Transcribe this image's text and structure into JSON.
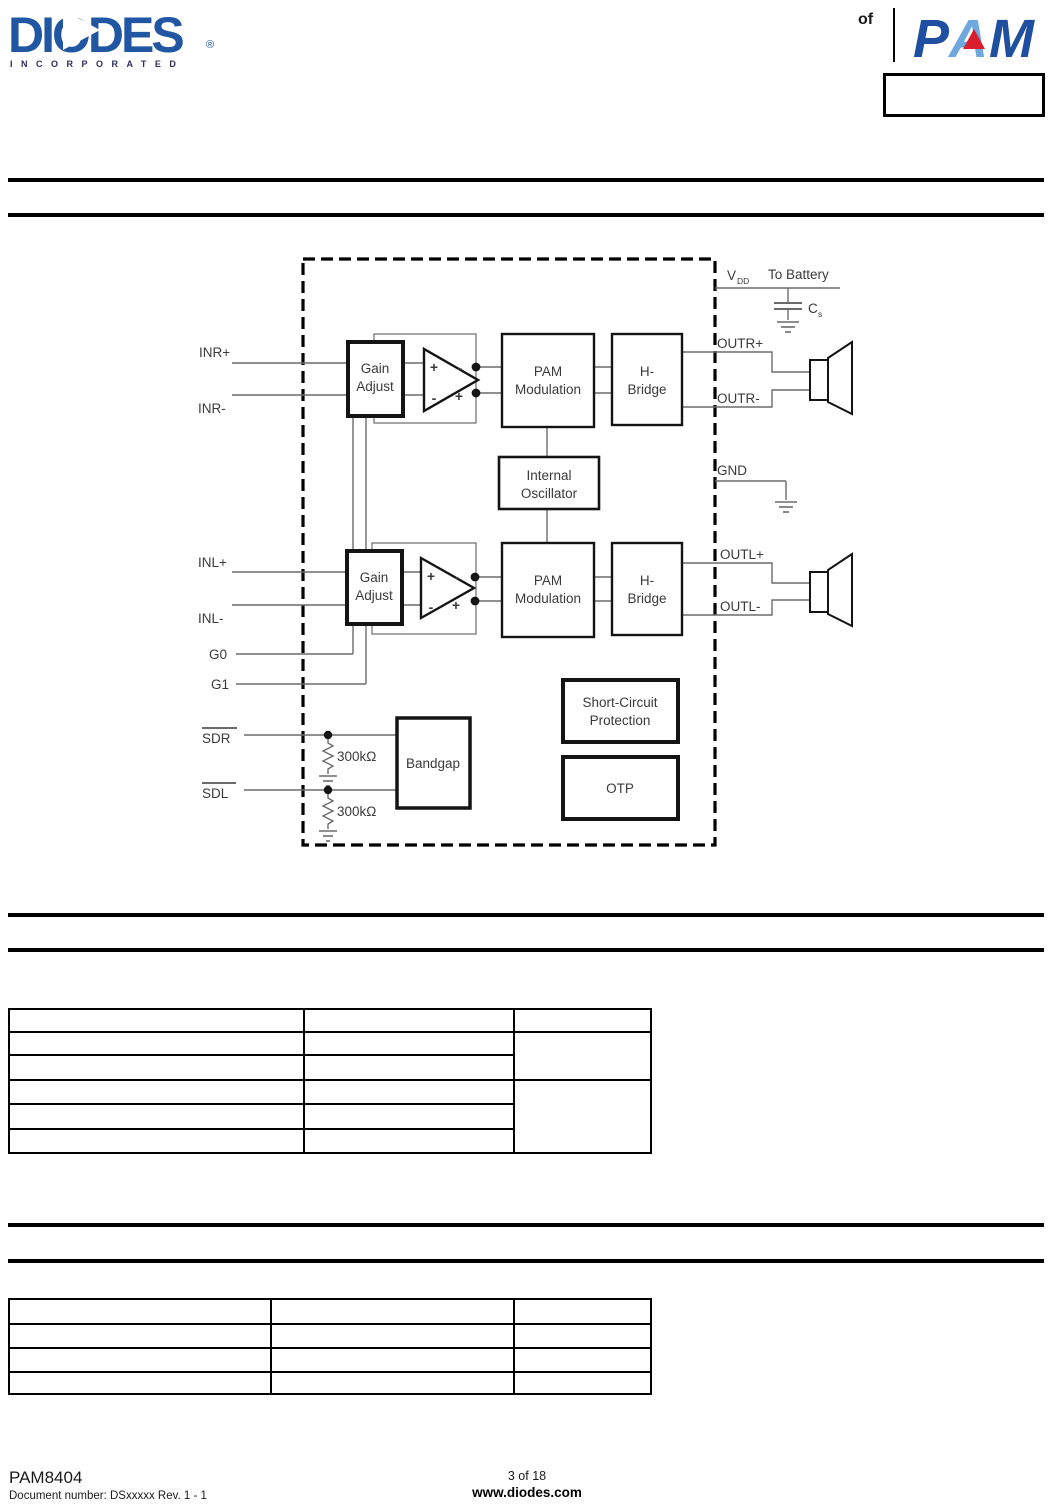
{
  "header": {
    "brand_name": "DIODES",
    "brand_registered": "®",
    "brand_subtitle": "INCORPORATED",
    "of_label": "of",
    "pam_letters": {
      "p": "P",
      "a": "A",
      "m": "M"
    }
  },
  "diagram": {
    "pins": {
      "inr_plus": "INR+",
      "inr_minus": "INR-",
      "inl_plus": "INL+",
      "inl_minus": "INL-",
      "g0": "G0",
      "g1": "G1",
      "sdr": "SDR",
      "sdl": "SDL",
      "outr_plus": "OUTR+",
      "outr_minus": "OUTR-",
      "outl_plus": "OUTL+",
      "outl_minus": "OUTL-",
      "gnd": "GND",
      "vdd_main": "V",
      "vdd_sub": "DD"
    },
    "annotations": {
      "to_battery": "To Battery",
      "cs_main": "C",
      "cs_sub": "s",
      "r_sdr": "300kΩ",
      "r_sdl": "300kΩ",
      "plus": "+",
      "minus": "-"
    },
    "blocks": {
      "gain_l1": "Gain",
      "gain_l2": "Adjust",
      "pam_l1": "PAM",
      "pam_l2": "Modulation",
      "hbridge_l1": "H-",
      "hbridge_l2": "Bridge",
      "osc_l1": "Internal",
      "osc_l2": "Oscillator",
      "scp_l1": "Short-Circuit",
      "scp_l2": "Protection",
      "otp": "OTP",
      "bandgap": "Bandgap"
    }
  },
  "table1": {
    "headers": [
      "",
      "",
      ""
    ],
    "rows": [
      [
        "",
        ""
      ],
      [
        "",
        ""
      ],
      [
        "",
        ""
      ],
      [
        "",
        ""
      ],
      [
        "",
        ""
      ]
    ]
  },
  "table2": {
    "rows": [
      [
        "",
        "",
        ""
      ],
      [
        "",
        "",
        ""
      ],
      [
        "",
        "",
        ""
      ],
      [
        "",
        "",
        ""
      ]
    ]
  },
  "footer": {
    "part_number": "PAM8404",
    "document_number": "Document number: DSxxxxx Rev. 1 - 1",
    "page_indicator": "3 of 18",
    "website": "www.diodes.com"
  }
}
